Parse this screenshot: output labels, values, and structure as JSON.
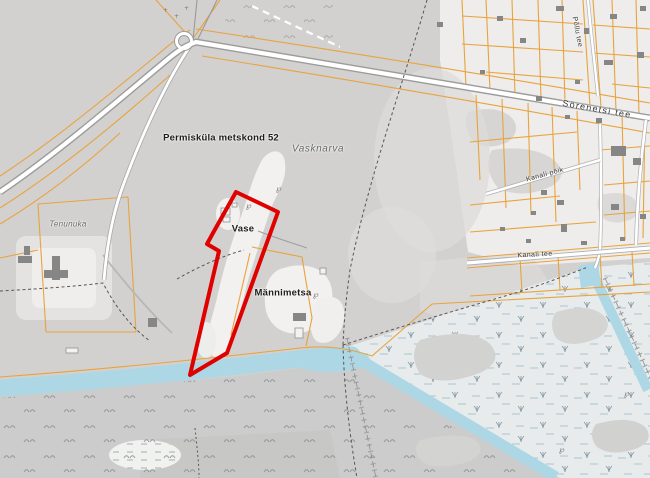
{
  "map": {
    "kind": "cadastral-topographic-map",
    "labels": {
      "forest_block": "Permisküla metskond 52",
      "village_name": "Vasknarva",
      "parcel_vase": "Vase",
      "parcel_mannimetsa": "Männimetsa",
      "place_tenunuka": "Tenunuka",
      "road_sorenetsi": "Sörenetsi tee",
      "road_kanali_poik": "Kanali põik",
      "road_kanali_tee": "Kanali tee",
      "road_pollu": "Põllu tee"
    },
    "highlight": {
      "name": "selected-parcel-outline",
      "outline_color": "#df0000"
    },
    "colors": {
      "forest_gray": "#d2d1d0",
      "open_light": "#eeedeb",
      "water_blue": "#aed7e6",
      "cadastral_orange": "#e8a33c",
      "road_fill": "#ffffff",
      "road_casing": "#9c9c9c",
      "marsh_bg": "#e8ebec",
      "building_gray": "#868686"
    }
  }
}
